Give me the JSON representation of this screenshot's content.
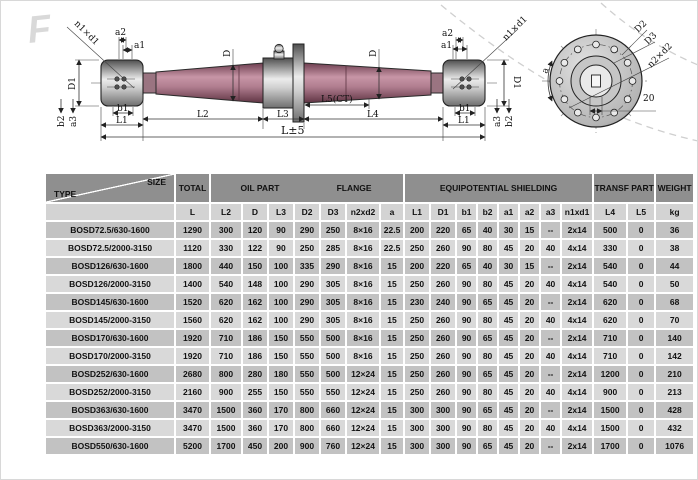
{
  "drawing": {
    "watermark": "F",
    "shaft": {
      "n1xd1_left": "n1×d1",
      "a2_left": "a2",
      "a1_left": "a1",
      "D1_left": "D1",
      "b2_left": "b2",
      "a3_left": "a3",
      "b1_left": "b1",
      "L1_left": "L1",
      "D_left": "D",
      "D_right": "D",
      "a2_right": "a2",
      "a1_right": "a1",
      "n1xd1_right": "n1×d1",
      "D1_right": "D1",
      "a3_right": "a3",
      "b2_right": "b2",
      "b1_right": "b1",
      "L1_right": "L1",
      "L2": "L2",
      "L3": "L3",
      "L5": "L5(CT)",
      "L4": "L4",
      "Ltotal": "L±5"
    },
    "end_view": {
      "D2": "D2",
      "D3": "D3",
      "n2xd2": "n2×d2",
      "spacing": "20",
      "angle": "a"
    }
  },
  "table": {
    "corner": {
      "top": "SIZE",
      "bottom": "TYPE"
    },
    "groups": {
      "total": "TOTAL",
      "oil_part": "OIL  PART",
      "flange": "FLANGE",
      "equipotential": "EQUIPOTENTIAL  SHIELDING",
      "transf_part": "TRANSF  PART",
      "weight": "WEIGHT"
    },
    "columns": [
      "L",
      "L2",
      "D",
      "L3",
      "D2",
      "D3",
      "n2xd2",
      "a",
      "L1",
      "D1",
      "b1",
      "b2",
      "a1",
      "a2",
      "a3",
      "n1xd1",
      "L4",
      "L5",
      "kg"
    ],
    "rows": [
      {
        "type": "BOSD72.5/630-1600",
        "values": [
          "1290",
          "300",
          "120",
          "90",
          "290",
          "250",
          "8×16",
          "22.5",
          "200",
          "220",
          "65",
          "40",
          "30",
          "15",
          "--",
          "2x14",
          "500",
          "0",
          "36"
        ]
      },
      {
        "type": "BOSD72.5/2000-3150",
        "values": [
          "1120",
          "330",
          "122",
          "90",
          "250",
          "285",
          "8×16",
          "22.5",
          "250",
          "260",
          "90",
          "80",
          "45",
          "20",
          "40",
          "4x14",
          "330",
          "0",
          "38"
        ]
      },
      {
        "type": "BOSD126/630-1600",
        "values": [
          "1800",
          "440",
          "150",
          "100",
          "335",
          "290",
          "8×16",
          "15",
          "200",
          "220",
          "65",
          "40",
          "30",
          "15",
          "--",
          "2x14",
          "540",
          "0",
          "44"
        ]
      },
      {
        "type": "BOSD126/2000-3150",
        "values": [
          "1400",
          "540",
          "148",
          "100",
          "290",
          "305",
          "8×16",
          "15",
          "250",
          "260",
          "90",
          "80",
          "45",
          "20",
          "40",
          "4x14",
          "540",
          "0",
          "50"
        ]
      },
      {
        "type": "BOSD145/630-1600",
        "values": [
          "1520",
          "620",
          "162",
          "100",
          "290",
          "305",
          "8×16",
          "15",
          "230",
          "240",
          "90",
          "65",
          "45",
          "20",
          "--",
          "2x14",
          "620",
          "0",
          "68"
        ]
      },
      {
        "type": "BOSD145/2000-3150",
        "values": [
          "1560",
          "620",
          "162",
          "100",
          "290",
          "305",
          "8×16",
          "15",
          "250",
          "260",
          "90",
          "80",
          "45",
          "20",
          "40",
          "4x14",
          "620",
          "0",
          "70"
        ]
      },
      {
        "type": "BOSD170/630-1600",
        "values": [
          "1920",
          "710",
          "186",
          "150",
          "550",
          "500",
          "8×16",
          "15",
          "250",
          "260",
          "90",
          "65",
          "45",
          "20",
          "--",
          "2x14",
          "710",
          "0",
          "140"
        ]
      },
      {
        "type": "BOSD170/2000-3150",
        "values": [
          "1920",
          "710",
          "186",
          "150",
          "550",
          "500",
          "8×16",
          "15",
          "250",
          "260",
          "90",
          "80",
          "45",
          "20",
          "40",
          "4x14",
          "710",
          "0",
          "142"
        ]
      },
      {
        "type": "BOSD252/630-1600",
        "values": [
          "2680",
          "800",
          "280",
          "180",
          "550",
          "500",
          "12×24",
          "15",
          "250",
          "260",
          "90",
          "65",
          "45",
          "20",
          "--",
          "2x14",
          "1200",
          "0",
          "210"
        ]
      },
      {
        "type": "BOSD252/2000-3150",
        "values": [
          "2160",
          "900",
          "255",
          "150",
          "550",
          "550",
          "12×24",
          "15",
          "250",
          "260",
          "90",
          "80",
          "45",
          "20",
          "40",
          "4x14",
          "900",
          "0",
          "213"
        ]
      },
      {
        "type": "BOSD363/630-1600",
        "values": [
          "3470",
          "1500",
          "360",
          "170",
          "800",
          "660",
          "12×24",
          "15",
          "300",
          "300",
          "90",
          "65",
          "45",
          "20",
          "--",
          "2x14",
          "1500",
          "0",
          "428"
        ]
      },
      {
        "type": "BOSD363/2000-3150",
        "values": [
          "3470",
          "1500",
          "360",
          "170",
          "800",
          "660",
          "12×24",
          "15",
          "300",
          "300",
          "90",
          "80",
          "45",
          "20",
          "40",
          "4x14",
          "1500",
          "0",
          "432"
        ]
      },
      {
        "type": "BOSD550/630-1600",
        "values": [
          "5200",
          "1700",
          "450",
          "200",
          "900",
          "760",
          "12×24",
          "15",
          "300",
          "300",
          "90",
          "65",
          "45",
          "20",
          "--",
          "2x14",
          "1700",
          "0",
          "1076"
        ]
      }
    ]
  }
}
